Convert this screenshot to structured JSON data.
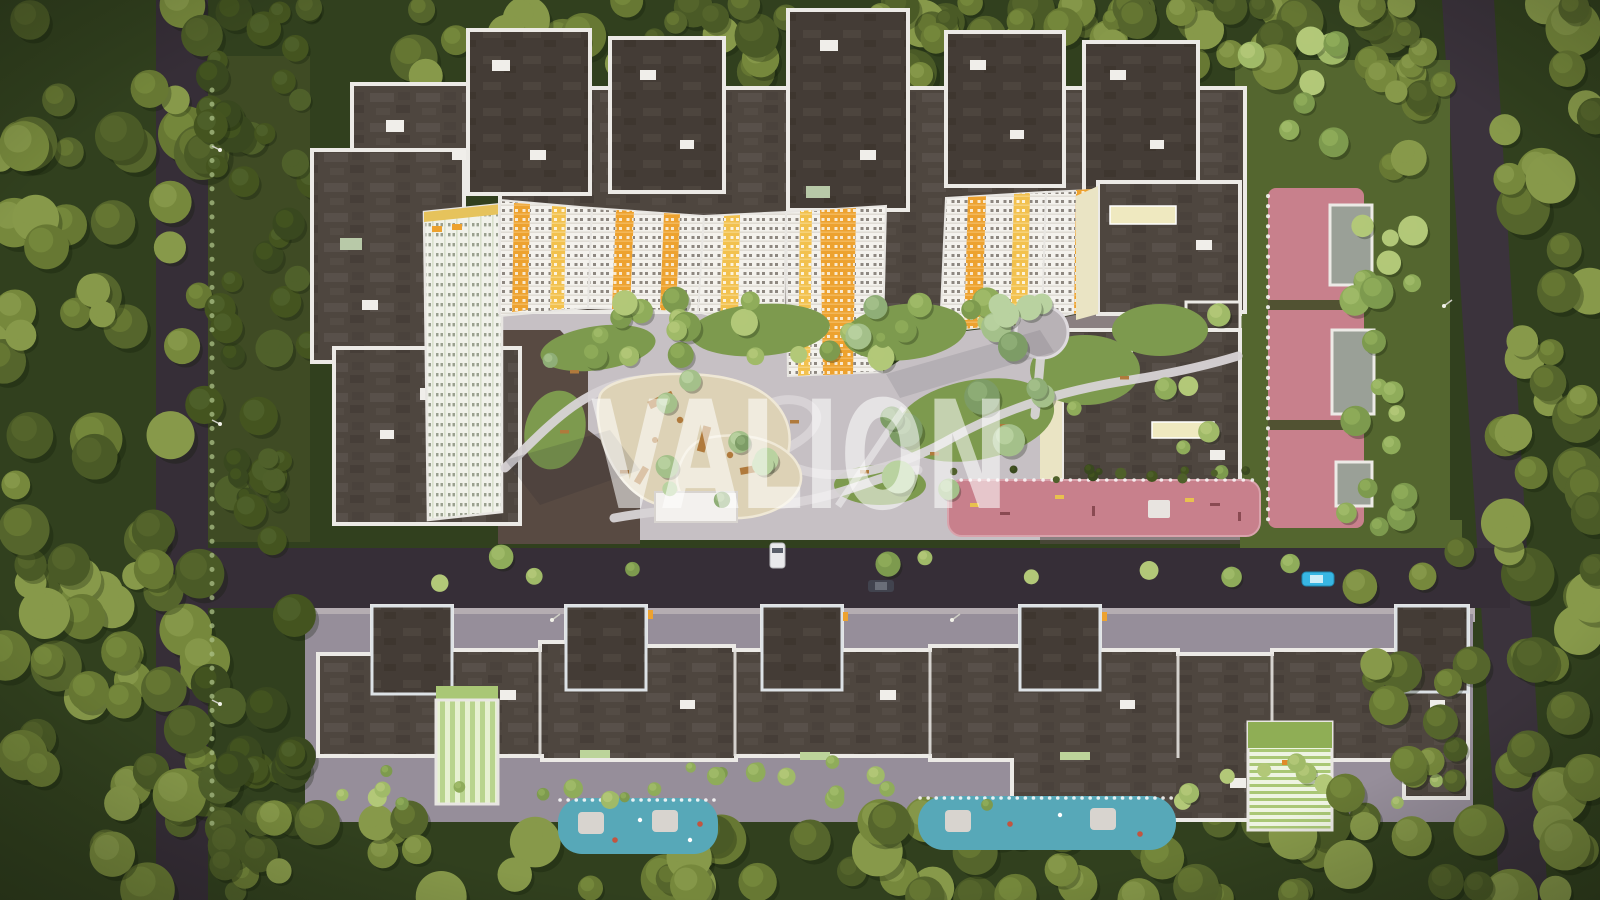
{
  "watermark": {
    "text": "VALION",
    "color": "#ffffff",
    "opacity": 0.55
  },
  "palette": {
    "forest_base": "#31401e",
    "road_asphalt": "#362e37",
    "road_right": "#3b333c",
    "sidewalk": "#b5adb2",
    "courtyard_paving": "#c6c0c4",
    "ground_brown": "#584a42",
    "ground_mauve": "#968e9a",
    "lawn_green": "#54662f",
    "lawn_bright": "#7d9a4e",
    "roof_dark": "#4e463f",
    "roof_frame": "#443c36",
    "parapet_white": "#eceae6",
    "facade_white": "#f4f2ed",
    "accent_orange": "#eda22f",
    "accent_yellow": "#f2c14e",
    "pale_green_panel": "#b9d48e",
    "cream_wall": "#eae4c4",
    "playground_sand": "#ddd2b6",
    "equipment_wood": "#b07a3c",
    "sport_pink": "#c8808c",
    "play_blue": "#57a8b8",
    "pavilion_gray": "#9aa097",
    "path_light": "#d8d4d6",
    "car_white": "#e9e9eb",
    "car_dark": "#41434e",
    "car_blue": "#38b6e3",
    "tree_olive": [
      "#4a5a26",
      "#55652c",
      "#677833",
      "#76883c",
      "#87994a"
    ],
    "tree_dark": [
      "#39481f",
      "#44541f",
      "#4f602a"
    ],
    "tree_bright": [
      "#7d9a4e",
      "#8fac5a",
      "#a0ba68",
      "#b2c878"
    ],
    "tree_mint": [
      "#7d9c66",
      "#8fae77",
      "#a4c08a",
      "#b9d2a0"
    ]
  },
  "scene_objects": {
    "vehicles": [
      {
        "name": "white-van",
        "color_ref": "car_white"
      },
      {
        "name": "dark-car",
        "color_ref": "car_dark"
      },
      {
        "name": "blue-car",
        "color_ref": "car_blue"
      }
    ]
  }
}
